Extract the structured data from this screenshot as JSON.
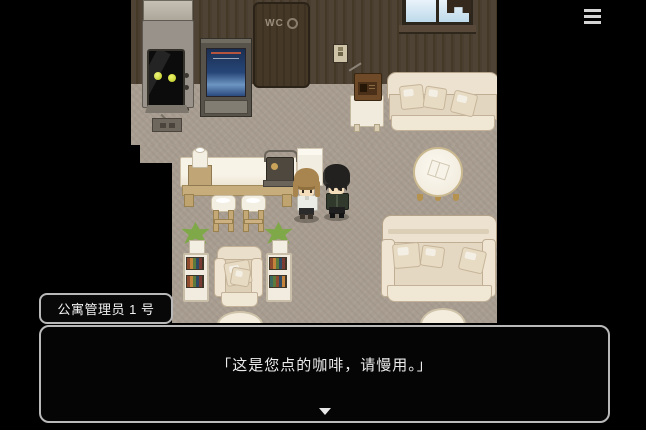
{
  "ui": {
    "menu_icon": "hamburger-menu",
    "dialogue": {
      "speaker": "公寓管理员 1 号",
      "text": "「这是您点的咖啡，请慢用。」",
      "continue_indicator": "down-arrow"
    }
  },
  "scene": {
    "door_label": "WC"
  },
  "colors": {
    "background": "#000000",
    "wall": "#4d4134",
    "floor": "#a89d90",
    "sofa": "#ece2cf",
    "counter_trim": "#c8ad7c",
    "robot_eyes": "#cdd93a",
    "kiosk_screen": "#264678",
    "plant": "#7fa848",
    "dialogue_background": "#050505",
    "dialogue_border": "#b9b9b9",
    "dialogue_text": "#ececec"
  }
}
